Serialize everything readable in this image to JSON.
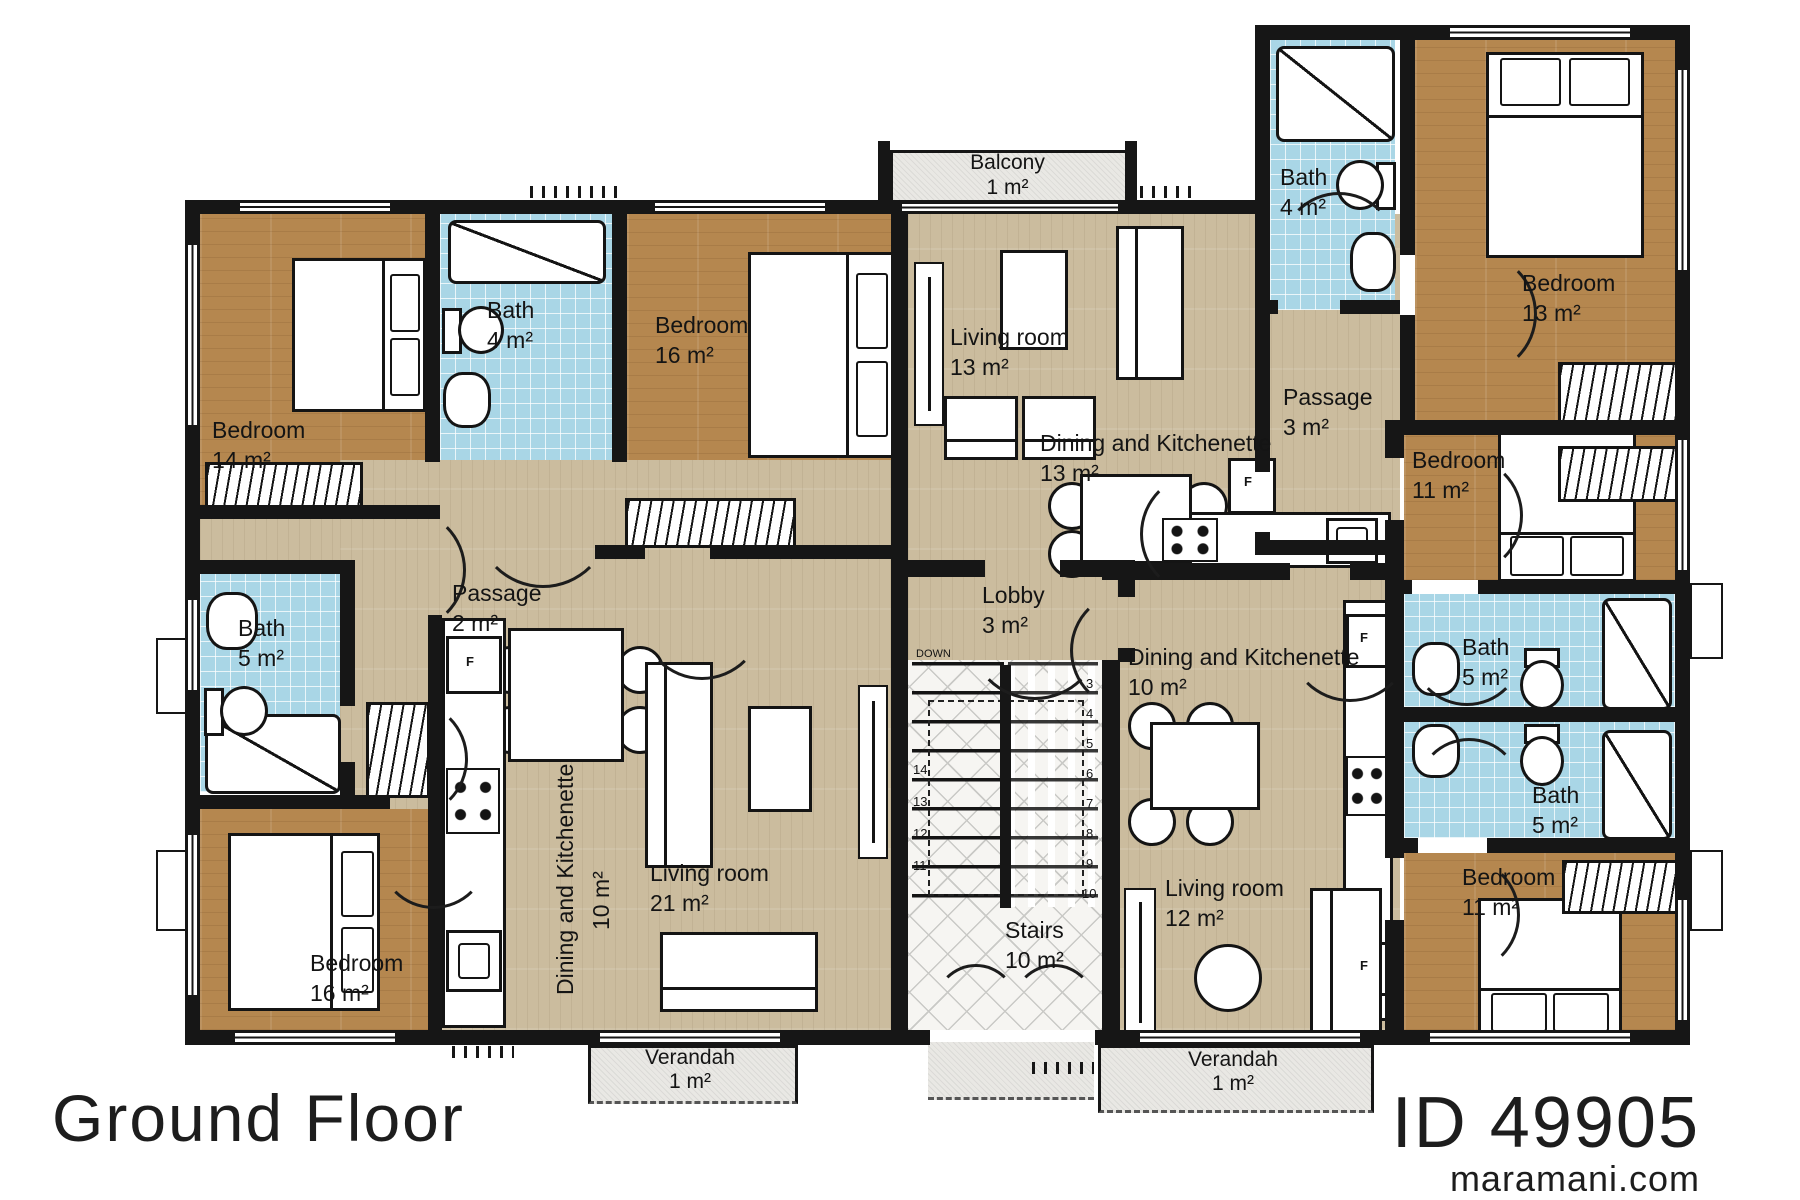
{
  "meta": {
    "floor_title": "Ground Floor",
    "plan_id": "ID 49905",
    "website": "maramani.com"
  },
  "rooms": {
    "balcony": {
      "name": "Balcony",
      "area": "1 m²"
    },
    "bedroom_14": {
      "name": "Bedroom",
      "area": "14 m²"
    },
    "bath_4_left": {
      "name": "Bath",
      "area": "4 m²"
    },
    "bedroom_16_top": {
      "name": "Bedroom",
      "area": "16 m²"
    },
    "living_13": {
      "name": "Living room",
      "area": "13 m²"
    },
    "dining_13": {
      "name": "Dining and Kitchenette",
      "area": "13 m²"
    },
    "bath_4_right": {
      "name": "Bath",
      "area": "4 m²"
    },
    "bedroom_13": {
      "name": "Bedroom",
      "area": "13 m²"
    },
    "passage_3": {
      "name": "Passage",
      "area": "3 m²"
    },
    "bedroom_11_upper": {
      "name": "Bedroom",
      "area": "11 m²"
    },
    "passage_2": {
      "name": "Passage",
      "area": "2 m²"
    },
    "bath_5_left": {
      "name": "Bath",
      "area": "5 m²"
    },
    "lobby": {
      "name": "Lobby",
      "area": "3 m²"
    },
    "dining_10_right": {
      "name": "Dining and Kitchenette",
      "area": "10 m²"
    },
    "bath_5_mid": {
      "name": "Bath",
      "area": "5 m²"
    },
    "bath_5_low": {
      "name": "Bath",
      "area": "5 m²"
    },
    "dining_10_left": {
      "name": "Dining and Kitchenette",
      "area": "10 m²"
    },
    "living_21": {
      "name": "Living room",
      "area": "21 m²"
    },
    "stairs": {
      "name": "Stairs",
      "area": "10 m²"
    },
    "living_12": {
      "name": "Living room",
      "area": "12 m²"
    },
    "bedroom_16_bottom": {
      "name": "Bedroom",
      "area": "16 m²"
    },
    "bedroom_11_lower": {
      "name": "Bedroom",
      "area": "11 m²"
    },
    "verandah_left": {
      "name": "Verandah",
      "area": "1 m²"
    },
    "verandah_right": {
      "name": "Verandah",
      "area": "1 m²"
    }
  },
  "stairs": {
    "down_label": "DOWN",
    "left_steps": [
      "14",
      "13",
      "12",
      "11"
    ],
    "right_steps": [
      "3",
      "4",
      "5",
      "6",
      "7",
      "8",
      "9",
      "10"
    ]
  },
  "appliances": {
    "fridge": "F"
  },
  "colors": {
    "wall": "#161616",
    "wood_dark": "#b5874f",
    "wood_light": "#cbbc9e",
    "tile_blue": "#a9d6e6",
    "paving": "#e9e8e4"
  }
}
